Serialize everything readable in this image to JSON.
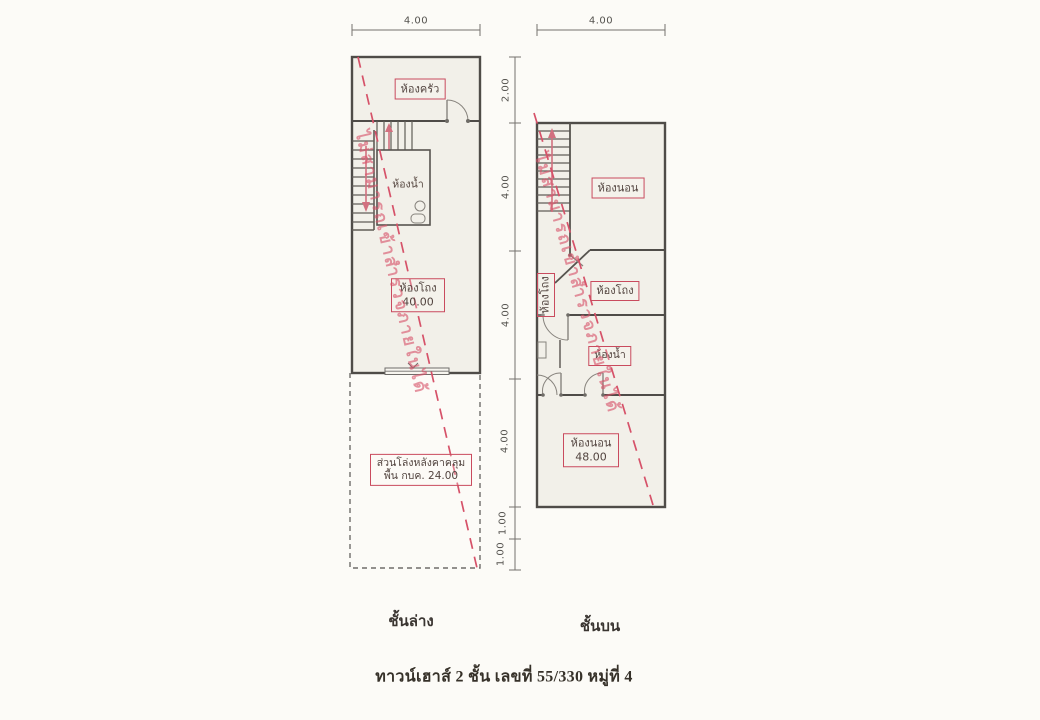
{
  "colors": {
    "accent_red": "#c94b5e",
    "watermark_pink": "#d65269",
    "wall": "#4f4c48",
    "paper_fill": "#f2f0e9",
    "background": "#fcfbf7"
  },
  "watermark": {
    "text": "ไม่สามารถเข้าสำรวจภายในได้"
  },
  "dimensions": {
    "ground_width": "4.00",
    "upper_width": "4.00",
    "vertical": [
      "2.00",
      "4.00",
      "4.00",
      "4.00",
      "1.00",
      "1.00"
    ]
  },
  "ground_floor": {
    "caption": "ชั้นล่าง",
    "kitchen": "ห้องครัว",
    "bathroom": "ห้องน้ำ",
    "hall": "ห้องโถง",
    "hall_area": "40.00",
    "open_area_line1": "ส่วนโล่งหลังคาคลุม",
    "open_area_line2": "พื้น กบค. 24.00"
  },
  "upper_floor": {
    "caption": "ชั้นบน",
    "bedroom_front": "ห้องนอน",
    "hall_vertical": "ห้องโถง",
    "hall": "ห้องโถง",
    "bathroom": "ห้องน้ำ",
    "bedroom_back": "ห้องนอน",
    "bedroom_back_area": "48.00"
  },
  "title": {
    "caption": "ทาวน์เฮาส์ 2 ชั้น เลขที่ 55/330 หมู่ที่ 4"
  }
}
